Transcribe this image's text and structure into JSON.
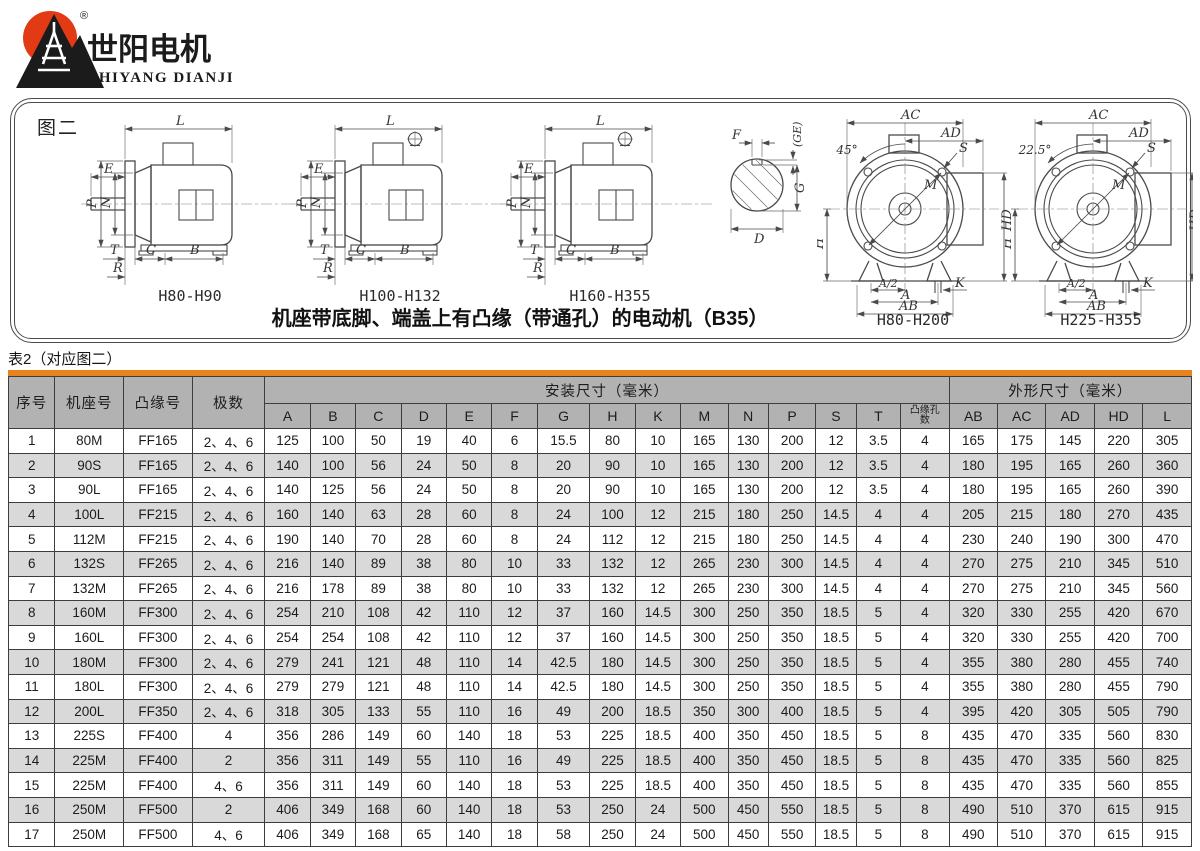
{
  "logo": {
    "name_cn": "世阳电机",
    "name_en": "SHIYANG DIANJI",
    "registered": "®",
    "sun_color": "#e23a14",
    "ink_color": "#1b1b1b"
  },
  "figure": {
    "box_label": "图二",
    "caption": "机座带底脚、端盖上有凸缘（带通孔）的电动机（B35）",
    "side_labels": {
      "L": "L",
      "E": "E",
      "P": "P",
      "N": "N",
      "T": "T",
      "R": "R",
      "C": "C",
      "B": "B"
    },
    "front_labels": {
      "AC": "AC",
      "AD": "AD",
      "S": "S",
      "M": "M",
      "H": "H",
      "HD": "HD",
      "A2": "A/2",
      "A": "A",
      "AB": "AB",
      "K": "K"
    },
    "shaft_labels": {
      "F": "F",
      "GE": "(GE)",
      "G": "G",
      "D": "D"
    },
    "drawings": [
      {
        "caption": "H80-H90"
      },
      {
        "caption": "H100-H132"
      },
      {
        "caption": "H160-H355"
      },
      {
        "caption": "H80-H200",
        "angle": "45°"
      },
      {
        "caption": "H225-H355",
        "angle": "22.5°"
      }
    ]
  },
  "table": {
    "title": "表2（对应图二）",
    "accent_color": "#e8821c",
    "header": {
      "seq": "序号",
      "frame": "机座号",
      "flange": "凸缘号",
      "poles": "极数",
      "install_group": "安装尺寸（毫米）",
      "outline_group": "外形尺寸（毫米）",
      "install_cols": [
        "A",
        "B",
        "C",
        "D",
        "E",
        "F",
        "G",
        "H",
        "K",
        "M",
        "N",
        "P",
        "S",
        "T",
        "凸缘孔数"
      ],
      "outline_cols": [
        "AB",
        "AC",
        "AD",
        "HD",
        "L"
      ]
    },
    "rows": [
      [
        "1",
        "80M",
        "FF165",
        "2、4、6",
        "125",
        "100",
        "50",
        "19",
        "40",
        "6",
        "15.5",
        "80",
        "10",
        "165",
        "130",
        "200",
        "12",
        "3.5",
        "4",
        "165",
        "175",
        "145",
        "220",
        "305"
      ],
      [
        "2",
        "90S",
        "FF165",
        "2、4、6",
        "140",
        "100",
        "56",
        "24",
        "50",
        "8",
        "20",
        "90",
        "10",
        "165",
        "130",
        "200",
        "12",
        "3.5",
        "4",
        "180",
        "195",
        "165",
        "260",
        "360"
      ],
      [
        "3",
        "90L",
        "FF165",
        "2、4、6",
        "140",
        "125",
        "56",
        "24",
        "50",
        "8",
        "20",
        "90",
        "10",
        "165",
        "130",
        "200",
        "12",
        "3.5",
        "4",
        "180",
        "195",
        "165",
        "260",
        "390"
      ],
      [
        "4",
        "100L",
        "FF215",
        "2、4、6",
        "160",
        "140",
        "63",
        "28",
        "60",
        "8",
        "24",
        "100",
        "12",
        "215",
        "180",
        "250",
        "14.5",
        "4",
        "4",
        "205",
        "215",
        "180",
        "270",
        "435"
      ],
      [
        "5",
        "112M",
        "FF215",
        "2、4、6",
        "190",
        "140",
        "70",
        "28",
        "60",
        "8",
        "24",
        "112",
        "12",
        "215",
        "180",
        "250",
        "14.5",
        "4",
        "4",
        "230",
        "240",
        "190",
        "300",
        "470"
      ],
      [
        "6",
        "132S",
        "FF265",
        "2、4、6",
        "216",
        "140",
        "89",
        "38",
        "80",
        "10",
        "33",
        "132",
        "12",
        "265",
        "230",
        "300",
        "14.5",
        "4",
        "4",
        "270",
        "275",
        "210",
        "345",
        "510"
      ],
      [
        "7",
        "132M",
        "FF265",
        "2、4、6",
        "216",
        "178",
        "89",
        "38",
        "80",
        "10",
        "33",
        "132",
        "12",
        "265",
        "230",
        "300",
        "14.5",
        "4",
        "4",
        "270",
        "275",
        "210",
        "345",
        "560"
      ],
      [
        "8",
        "160M",
        "FF300",
        "2、4、6",
        "254",
        "210",
        "108",
        "42",
        "110",
        "12",
        "37",
        "160",
        "14.5",
        "300",
        "250",
        "350",
        "18.5",
        "5",
        "4",
        "320",
        "330",
        "255",
        "420",
        "670"
      ],
      [
        "9",
        "160L",
        "FF300",
        "2、4、6",
        "254",
        "254",
        "108",
        "42",
        "110",
        "12",
        "37",
        "160",
        "14.5",
        "300",
        "250",
        "350",
        "18.5",
        "5",
        "4",
        "320",
        "330",
        "255",
        "420",
        "700"
      ],
      [
        "10",
        "180M",
        "FF300",
        "2、4、6",
        "279",
        "241",
        "121",
        "48",
        "110",
        "14",
        "42.5",
        "180",
        "14.5",
        "300",
        "250",
        "350",
        "18.5",
        "5",
        "4",
        "355",
        "380",
        "280",
        "455",
        "740"
      ],
      [
        "11",
        "180L",
        "FF300",
        "2、4、6",
        "279",
        "279",
        "121",
        "48",
        "110",
        "14",
        "42.5",
        "180",
        "14.5",
        "300",
        "250",
        "350",
        "18.5",
        "5",
        "4",
        "355",
        "380",
        "280",
        "455",
        "790"
      ],
      [
        "12",
        "200L",
        "FF350",
        "2、4、6",
        "318",
        "305",
        "133",
        "55",
        "110",
        "16",
        "49",
        "200",
        "18.5",
        "350",
        "300",
        "400",
        "18.5",
        "5",
        "4",
        "395",
        "420",
        "305",
        "505",
        "790"
      ],
      [
        "13",
        "225S",
        "FF400",
        "4",
        "356",
        "286",
        "149",
        "60",
        "140",
        "18",
        "53",
        "225",
        "18.5",
        "400",
        "350",
        "450",
        "18.5",
        "5",
        "8",
        "435",
        "470",
        "335",
        "560",
        "830"
      ],
      [
        "14",
        "225M",
        "FF400",
        "2",
        "356",
        "311",
        "149",
        "55",
        "110",
        "16",
        "49",
        "225",
        "18.5",
        "400",
        "350",
        "450",
        "18.5",
        "5",
        "8",
        "435",
        "470",
        "335",
        "560",
        "825"
      ],
      [
        "15",
        "225M",
        "FF400",
        "4、6",
        "356",
        "311",
        "149",
        "60",
        "140",
        "18",
        "53",
        "225",
        "18.5",
        "400",
        "350",
        "450",
        "18.5",
        "5",
        "8",
        "435",
        "470",
        "335",
        "560",
        "855"
      ],
      [
        "16",
        "250M",
        "FF500",
        "2",
        "406",
        "349",
        "168",
        "60",
        "140",
        "18",
        "53",
        "250",
        "24",
        "500",
        "450",
        "550",
        "18.5",
        "5",
        "8",
        "490",
        "510",
        "370",
        "615",
        "915"
      ],
      [
        "17",
        "250M",
        "FF500",
        "4、6",
        "406",
        "349",
        "168",
        "65",
        "140",
        "18",
        "58",
        "250",
        "24",
        "500",
        "450",
        "550",
        "18.5",
        "5",
        "8",
        "490",
        "510",
        "370",
        "615",
        "915"
      ]
    ]
  }
}
